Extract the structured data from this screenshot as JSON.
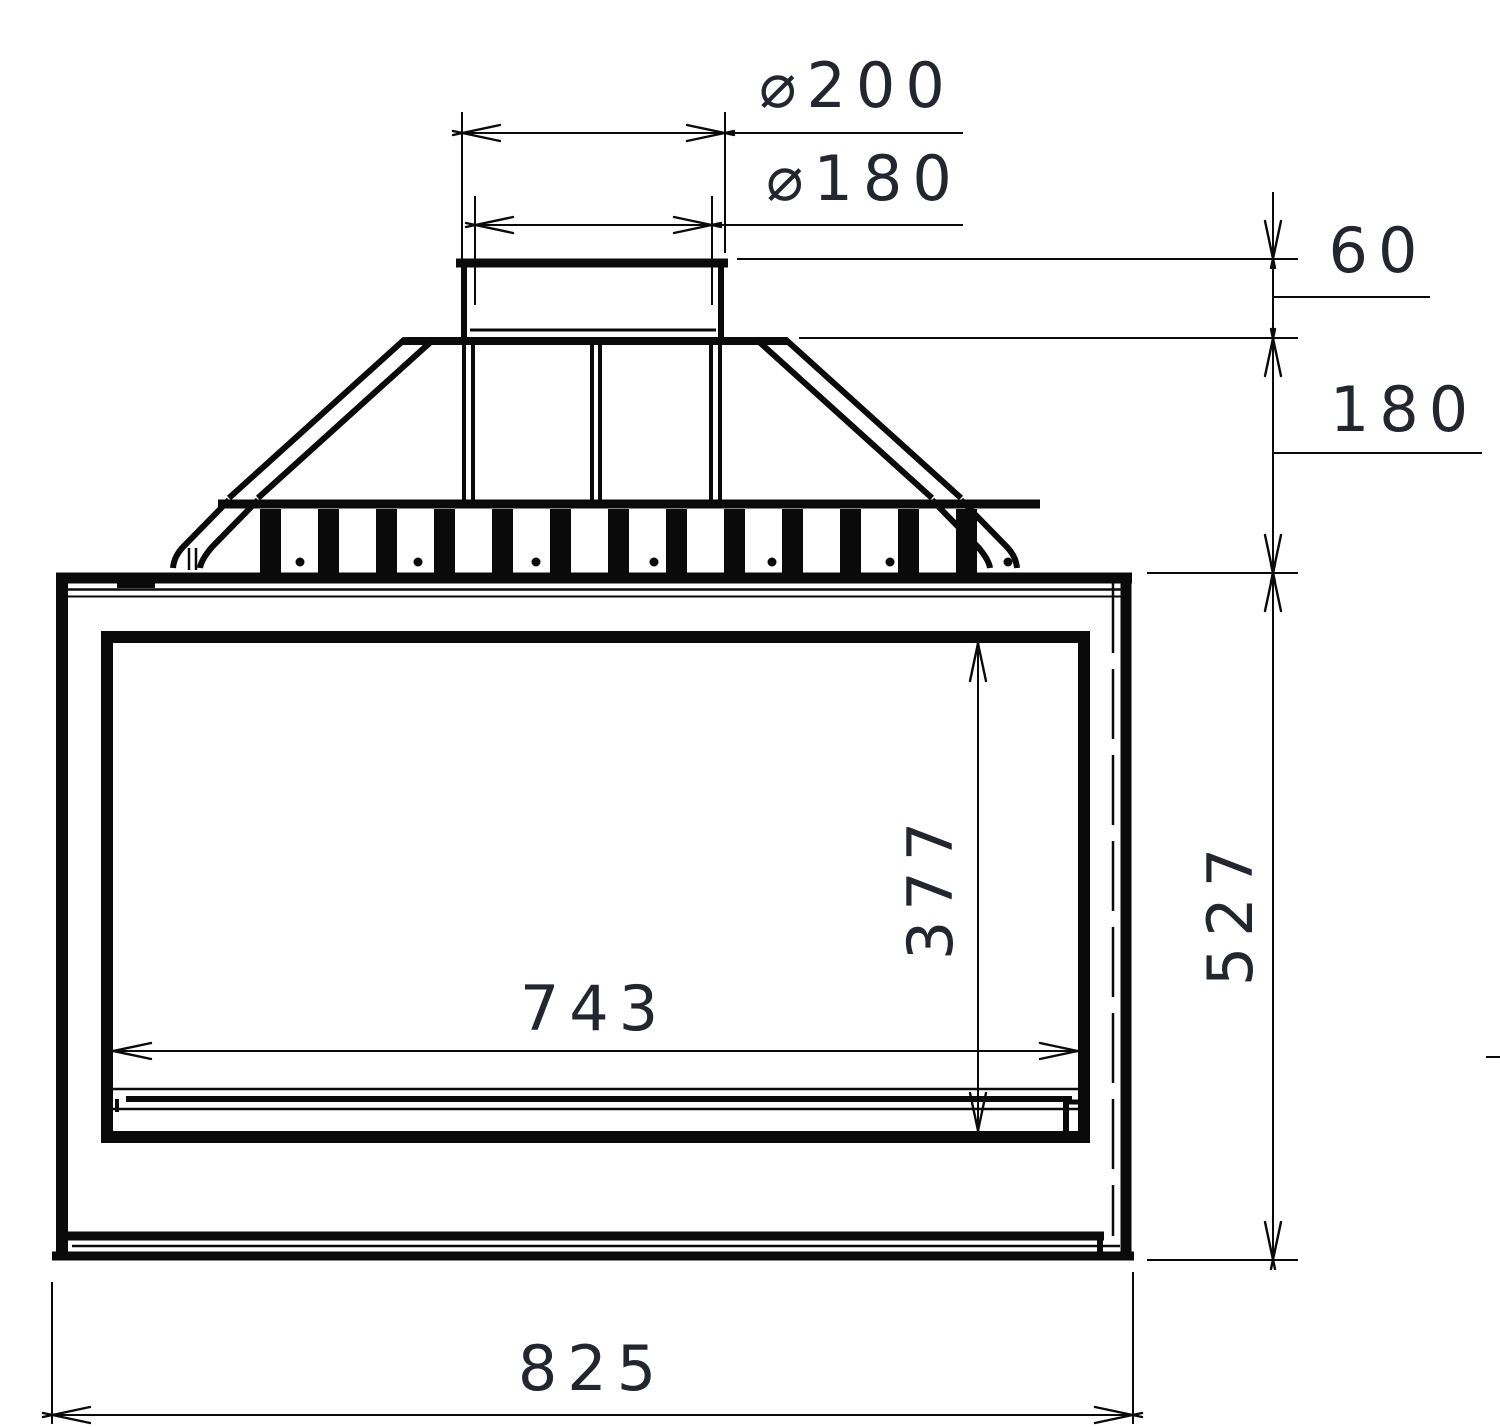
{
  "page": {
    "background": "#ffffff"
  },
  "drawing": {
    "kind": "fireplace-insert-front-elevation",
    "line_color": "#0a0a0a",
    "text_color": "#23262e"
  },
  "dims": {
    "flue_outer": {
      "label": "⌀200"
    },
    "flue_inner": {
      "label": "⌀180"
    },
    "collar_height": {
      "label": "60"
    },
    "hood_height": {
      "label": "180"
    },
    "glass_width": {
      "label": "743"
    },
    "glass_height": {
      "label": "377"
    },
    "body_height": {
      "label": "527"
    },
    "body_width": {
      "label": "825"
    }
  }
}
